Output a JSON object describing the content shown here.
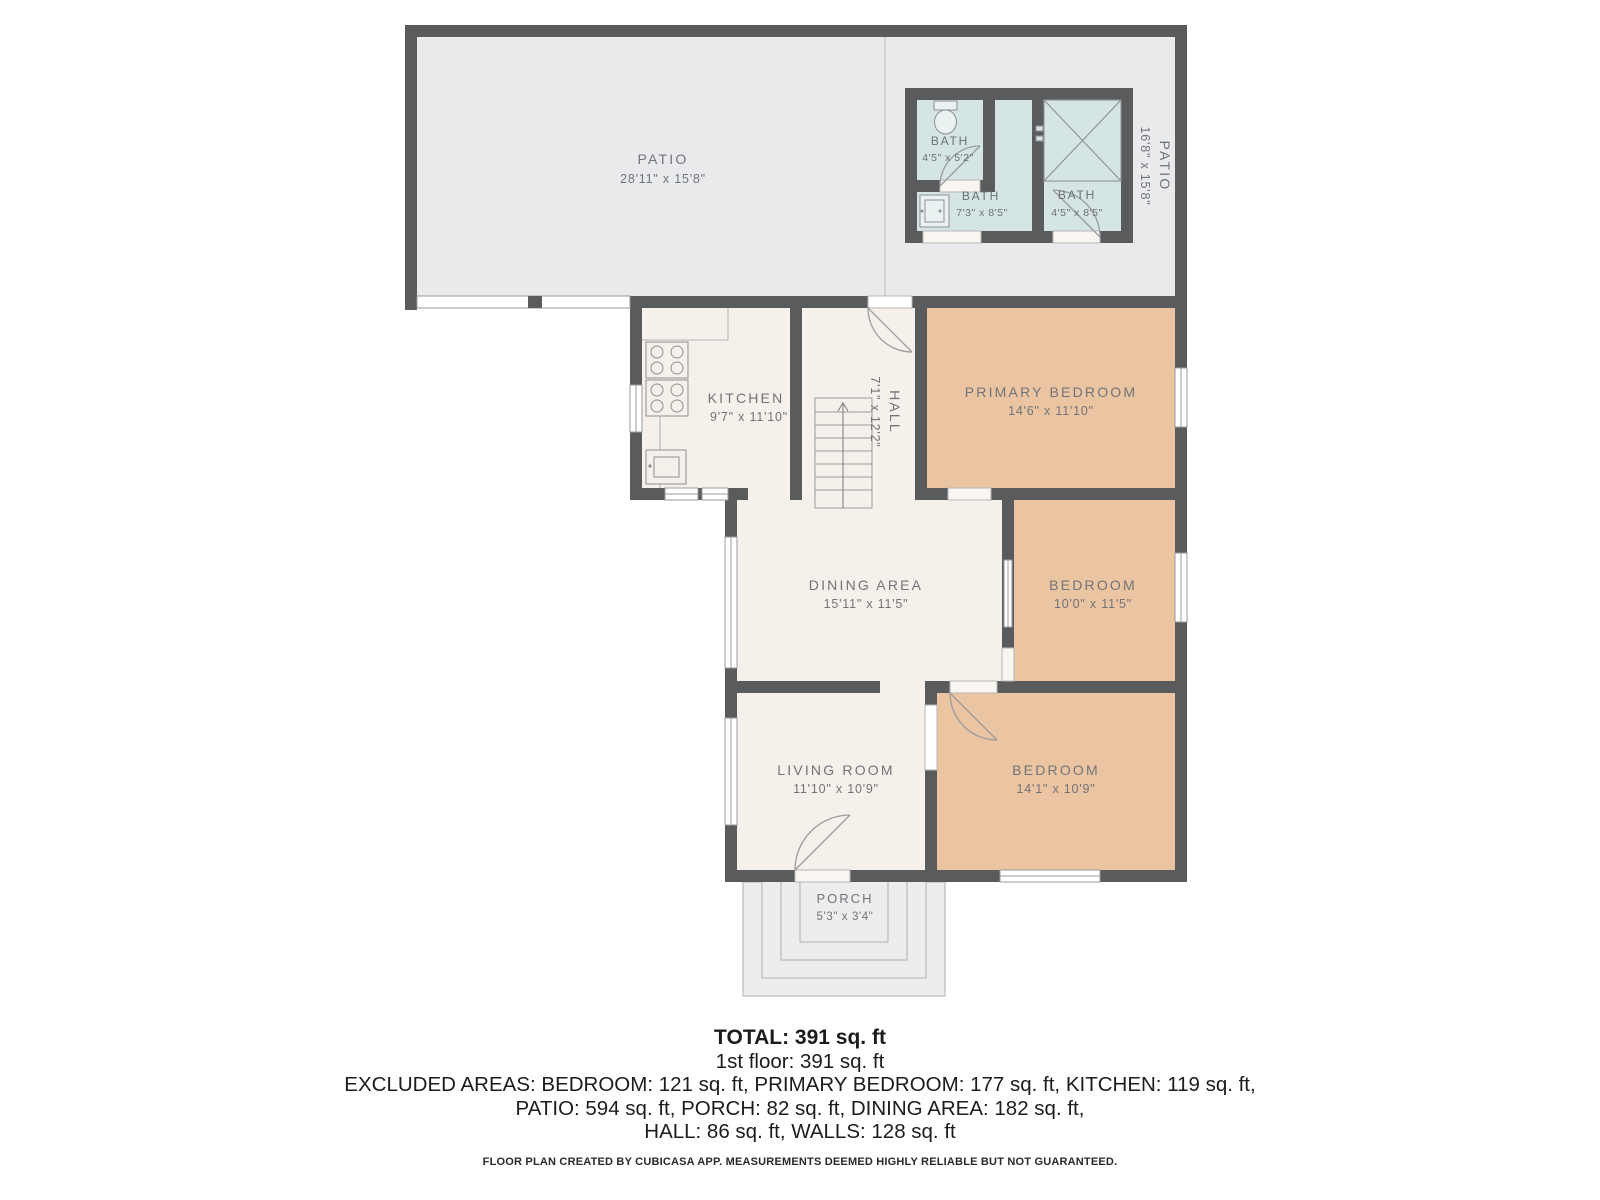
{
  "rooms": {
    "patio_main": {
      "name": "PATIO",
      "dims": "28'11\" x 15'8\""
    },
    "patio_side": {
      "name": "PATIO",
      "dims": "16'8\" x 15'8\""
    },
    "bath_top": {
      "name": "BATH",
      "dims": "4'5\" x 5'2\""
    },
    "bath_mid": {
      "name": "BATH",
      "dims": "7'3\" x 8'5\""
    },
    "bath_right": {
      "name": "BATH",
      "dims": "4'5\" x 8'5\""
    },
    "kitchen": {
      "name": "KITCHEN",
      "dims": "9'7\" x 11'10\""
    },
    "hall": {
      "name": "HALL",
      "dims": "7'1\" x 12'2\""
    },
    "primary_bedroom": {
      "name": "PRIMARY BEDROOM",
      "dims": "14'6\" x 11'10\""
    },
    "dining": {
      "name": "DINING AREA",
      "dims": "15'11\" x 11'5\""
    },
    "bedroom_mid": {
      "name": "BEDROOM",
      "dims": "10'0\" x 11'5\""
    },
    "living": {
      "name": "LIVING ROOM",
      "dims": "11'10\" x 10'9\""
    },
    "bedroom_bottom": {
      "name": "BEDROOM",
      "dims": "14'1\" x 10'9\""
    },
    "porch": {
      "name": "PORCH",
      "dims": "5'3\" x 3'4\""
    }
  },
  "summary": {
    "total": "TOTAL: 391 sq. ft",
    "floor": "1st floor: 391 sq. ft",
    "excluded_line1": "EXCLUDED AREAS: BEDROOM: 121 sq. ft, PRIMARY BEDROOM: 177 sq. ft, KITCHEN: 119 sq. ft,",
    "excluded_line2": "PATIO: 594 sq. ft, PORCH: 82 sq. ft, DINING AREA: 182 sq. ft,",
    "excluded_line3": "HALL: 86 sq. ft, WALLS: 128 sq. ft"
  },
  "footer": "FLOOR PLAN CREATED BY CUBICASA APP. MEASUREMENTS DEEMED HIGHLY RELIABLE BUT NOT GUARANTEED.",
  "colors": {
    "wall": "#5a5b5d",
    "patio_floor": "#e9eaeb",
    "interior_floor": "#f6f0ea",
    "bedroom_floor": "#ebc4a1",
    "bath_floor": "#d5e4e5",
    "porch_floor": "#ededee",
    "label_text": "#71747a",
    "fixture_line": "#8f9092",
    "summary_text": "#1c1c1c"
  }
}
